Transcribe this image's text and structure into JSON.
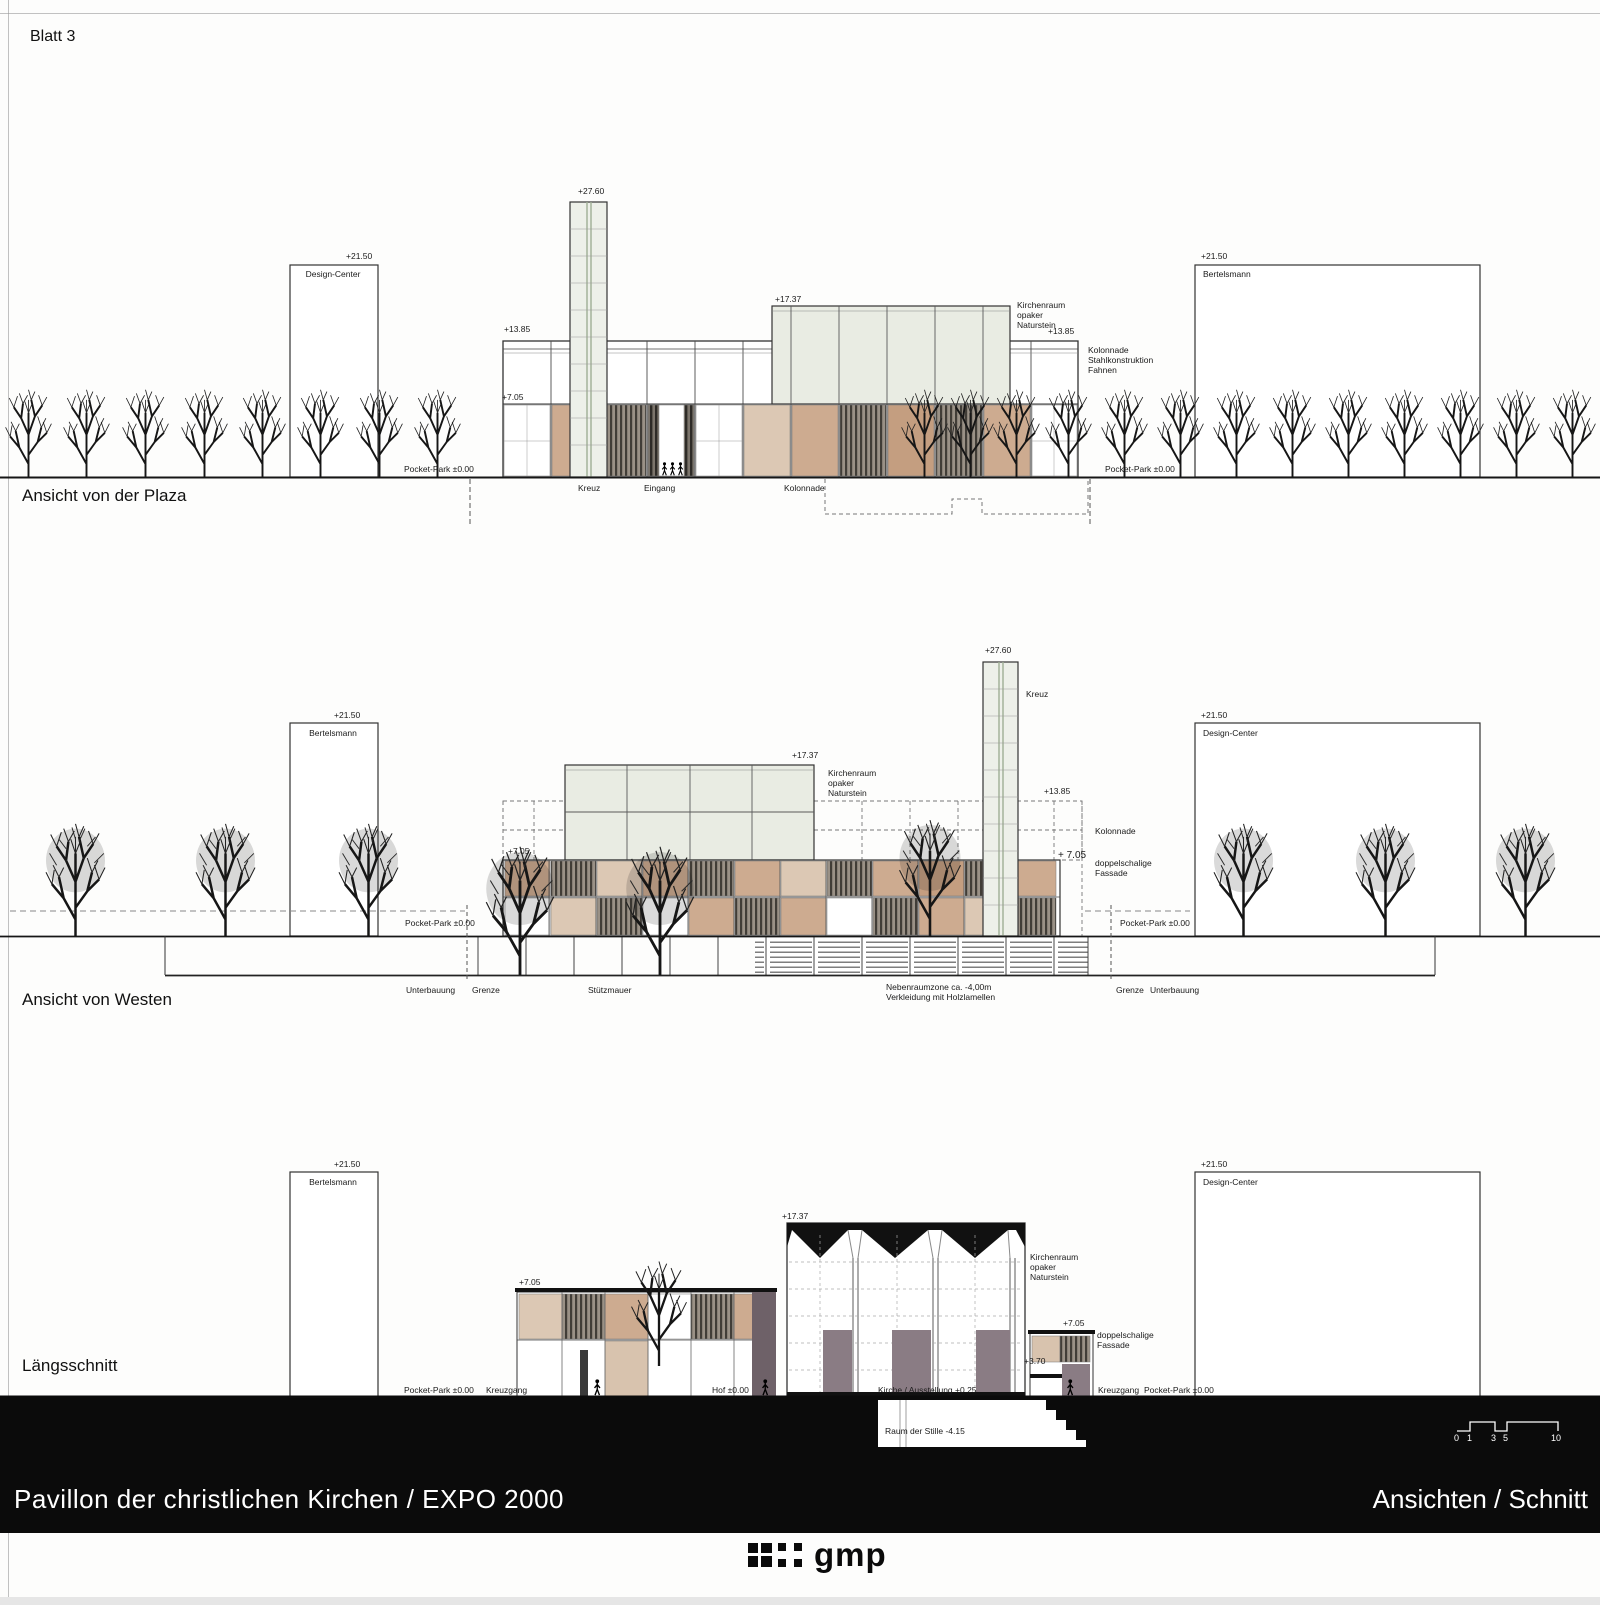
{
  "sheet": {
    "blatt": "Blatt  3"
  },
  "plaza": {
    "title": "Ansicht von der Plaza",
    "lv2150l": "+21.50",
    "design": "Design-Center",
    "lv2150r": "+21.50",
    "bertelsmann": "Bertelsmann",
    "lv2760": "+27.60",
    "lv1737": "+17.37",
    "lv1385l": "+13.85",
    "lv1385r": "+13.85",
    "lv705": "+7.05",
    "kirchenraum": "Kirchenraum\nopaker\nNaturstein",
    "kolonnade_note": "Kolonnade\nStahlkonstruktion\nFahnen",
    "pocketl": "Pocket-Park ±0.00",
    "pocketr": "Pocket-Park ±0.00",
    "kreuz": "Kreuz",
    "eingang": "Eingang",
    "kolonnade": "Kolonnade"
  },
  "westen": {
    "title": "Ansicht von Westen",
    "lv2150l": "+21.50",
    "bertelsmann": "Bertelsmann",
    "lv2150r": "+21.50",
    "design": "Design-Center",
    "lv2760": "+27.60",
    "kreuz": "Kreuz",
    "lv1737": "+17.37",
    "kirchenraum": "Kirchenraum\nopaker\nNaturstein",
    "lv1385": "+13.85",
    "kolonnade": "Kolonnade",
    "lv705l": "+7.05",
    "lv705r": "+ 7.05",
    "fassade": "doppelschalige\nFassade",
    "pocketl": "Pocket-Park ±0.00",
    "pocketr": "Pocket-Park ±0.00",
    "unterbauungl": "Unterbauung",
    "grenzel": "Grenze",
    "stuetzmauer": "Stützmauer",
    "nebenraum": "Nebenraumzone ca. -4,00m\nVerkleidung mit Holzlamellen",
    "grenzer": "Grenze",
    "unterbauungr": "Unterbauung"
  },
  "schnitt": {
    "title": "Längsschnitt",
    "lv2150l": "+21.50",
    "bertelsmann": "Bertelsmann",
    "lv2150r": "+21.50",
    "design": "Design-Center",
    "lv1737": "+17.37",
    "kirchenraum": "Kirchenraum\nopaker\nNaturstein",
    "lv705l": "+7.05",
    "lv705r": "+7.05",
    "fassade": "doppelschalige\nFassade",
    "lv370": "+3.70",
    "pocketl": "Pocket-Park ±0.00",
    "kreuzgangl": "Kreuzgang",
    "hof": "Hof ±0.00",
    "kirche": "Kirche / Ausstellung +0.25",
    "raum": "Raum der Stille -4.15",
    "kreuzgangr": "Kreuzgang",
    "pocketr": "Pocket-Park ±0.00"
  },
  "titlebar": {
    "title": "Pavillon der christlichen Kirchen / EXPO 2000",
    "subtitle": "Ansichten / Schnitt"
  },
  "logo": {
    "text": "gmp"
  },
  "scalebar": {
    "n0": "0",
    "n1": "1",
    "n3": "3",
    "n5": "5",
    "n10": "10"
  }
}
